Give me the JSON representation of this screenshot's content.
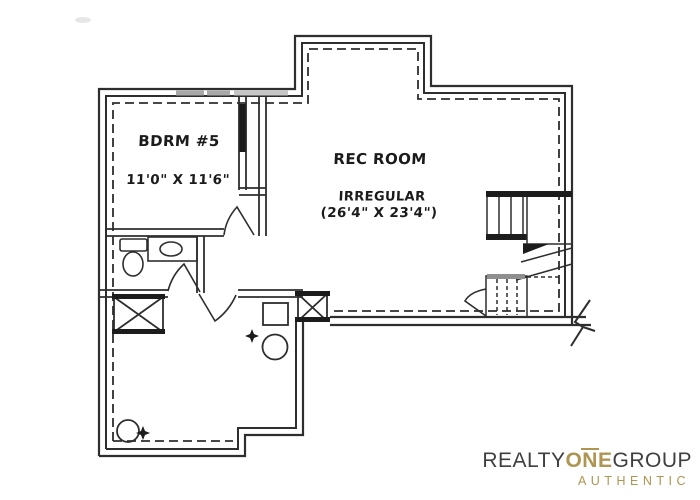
{
  "canvas": {
    "width": 700,
    "height": 500,
    "background": "#ffffff",
    "line_color": "#2e2e2e"
  },
  "floor_plan": {
    "rooms": [
      {
        "name": "BDRM #5",
        "dimensions": "11'0\" X 11'6\""
      },
      {
        "name": "REC ROOM",
        "shape": "IRREGULAR",
        "dimensions": "(26'4\" X 23'4\")"
      }
    ],
    "symbols": [
      "staircase",
      "toilet-icon",
      "sink-vanity-icon",
      "window-well-icon",
      "furnace-icon",
      "water-heater-icon",
      "floor-drain-icon",
      "sump-pump-icon",
      "door-swing",
      "wall-break-icon"
    ]
  },
  "branding": {
    "line1": [
      {
        "text": "REALTY",
        "color": "#3f3f41"
      },
      {
        "text": "ONE",
        "color": "#ae9551"
      },
      {
        "text": "GROUP",
        "color": "#3f3f41"
      }
    ],
    "line2": "AUTHENTIC",
    "gold": "#ae9551",
    "dark": "#3f3f41"
  }
}
